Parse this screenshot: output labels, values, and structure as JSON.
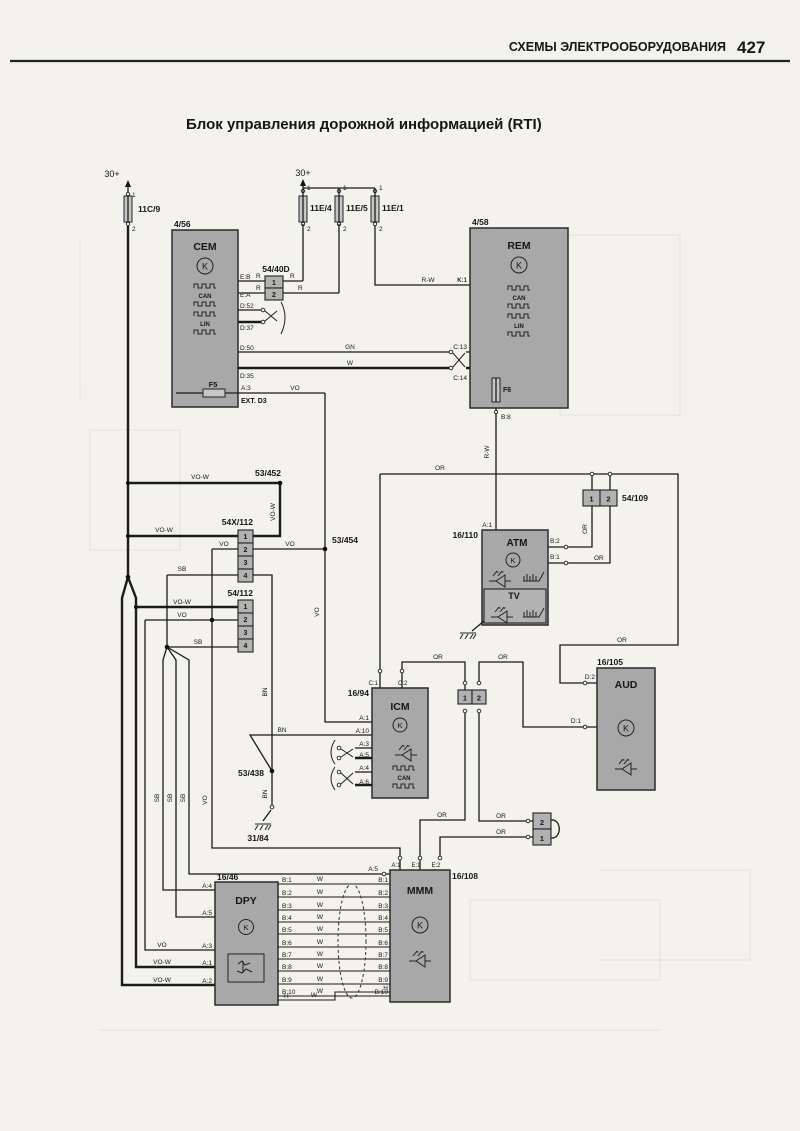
{
  "header": {
    "section_title": "СХЕМЫ ЭЛЕКТРООБОРУДОВАНИЯ",
    "page_number": "427"
  },
  "title": "Блок управления дорожной информацией (RTI)",
  "power_label": "30+",
  "wire_colors": {
    "r": "R",
    "rw": "R-W",
    "gn": "GN",
    "w": "W",
    "vo": "VO",
    "vow": "VO-W",
    "sb": "SB",
    "bn": "BN",
    "or": "OR"
  },
  "symbols": {
    "k": "K",
    "can": "CAN",
    "lin": "LIN"
  },
  "fuses": {
    "left": "11C/9",
    "mid1": "11E/4",
    "mid2": "11E/5",
    "mid3": "11E/1"
  },
  "connectors": {
    "pins": [
      "1",
      "2",
      "3",
      "4"
    ],
    "c54_40d": "54/40D",
    "c54x_112": "54X/112",
    "c54_112": "54/112",
    "c54_109": "54/109"
  },
  "splices": {
    "s53_452": "53/452",
    "s53_454": "53/454",
    "s53_438": "53/438"
  },
  "ground": {
    "g31_84": "31/84"
  },
  "cem": {
    "ref": "4/56",
    "name": "CEM",
    "fuse": "F5",
    "ext": "EXT. D3",
    "pins": {
      "eb": "E:B",
      "ea": "E:A",
      "d52": "D:52",
      "d37": "D:37",
      "d50": "D:50",
      "d35": "D:35",
      "a3": "A:3"
    }
  },
  "rem": {
    "ref": "4/58",
    "name": "REM",
    "fuse": "F6",
    "pins": {
      "k1": "K:1",
      "c13": "C:13",
      "c14": "C:14",
      "b8": "B:8"
    }
  },
  "atm": {
    "ref": "16/110",
    "name": "ATM",
    "tv_name": "TV",
    "pins": {
      "a1": "A:1",
      "b2": "B:2",
      "b1": "B:1"
    }
  },
  "icm": {
    "ref": "16/94",
    "name": "ICM",
    "pins": {
      "c1": "C:1",
      "c2": "C:2",
      "a1": "A:1",
      "a10": "A:10",
      "a3": "A:3",
      "a5": "A:5",
      "a4": "A:4",
      "a6": "A:6"
    }
  },
  "aud": {
    "ref": "16/105",
    "name": "AUD",
    "pins": {
      "d2": "D:2",
      "d1": "D:1"
    }
  },
  "dpy": {
    "ref": "16/46",
    "name": "DPY",
    "pin_h": "H",
    "pins_left": [
      "A:4",
      "A:5",
      "A:3",
      "A:1",
      "A:2"
    ],
    "pins_right": [
      "B:1",
      "B:2",
      "B:3",
      "B:4",
      "B:5",
      "B:6",
      "B:7",
      "B:8",
      "B:9",
      "B:10"
    ]
  },
  "mmm": {
    "ref": "16/108",
    "name": "MMM",
    "pin_h": "H",
    "pin_a5": "A:5",
    "pins_top": [
      "A:1",
      "E:1",
      "E:2"
    ],
    "pins_left": [
      "B:1",
      "B:2",
      "B:3",
      "B:4",
      "B:5",
      "B:6",
      "B:7",
      "B:8",
      "B:9",
      "B:10"
    ]
  }
}
